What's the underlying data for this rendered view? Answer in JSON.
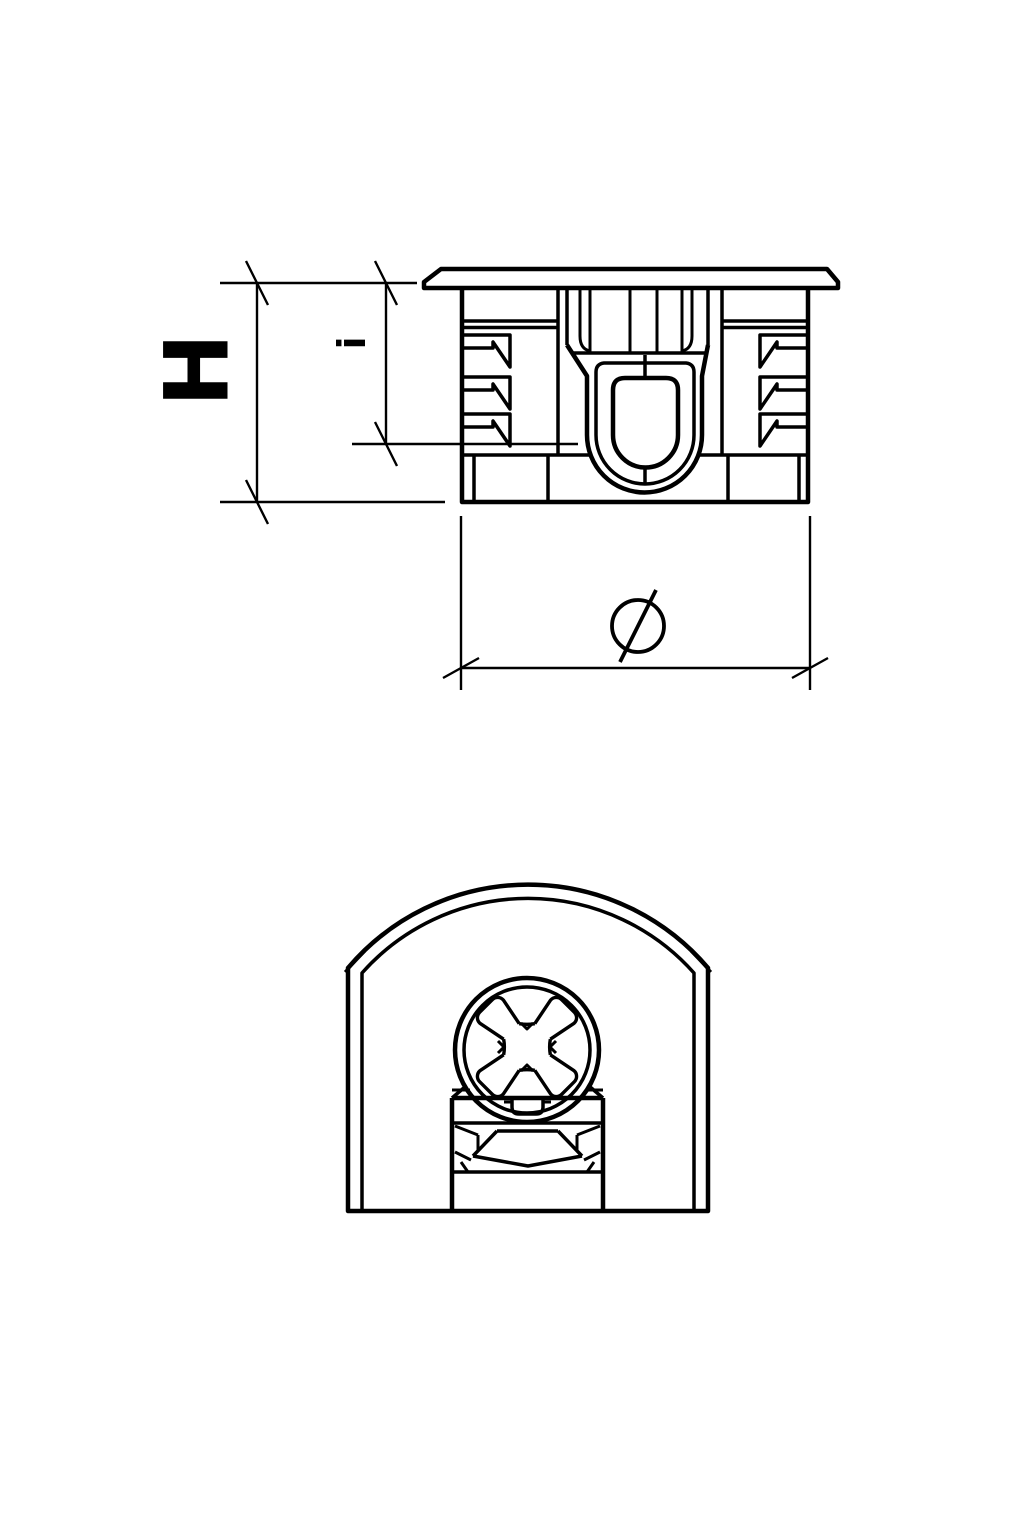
{
  "drawing": {
    "labels": {
      "height": "H",
      "inset_depth": "i",
      "diameter": "Ø"
    }
  }
}
